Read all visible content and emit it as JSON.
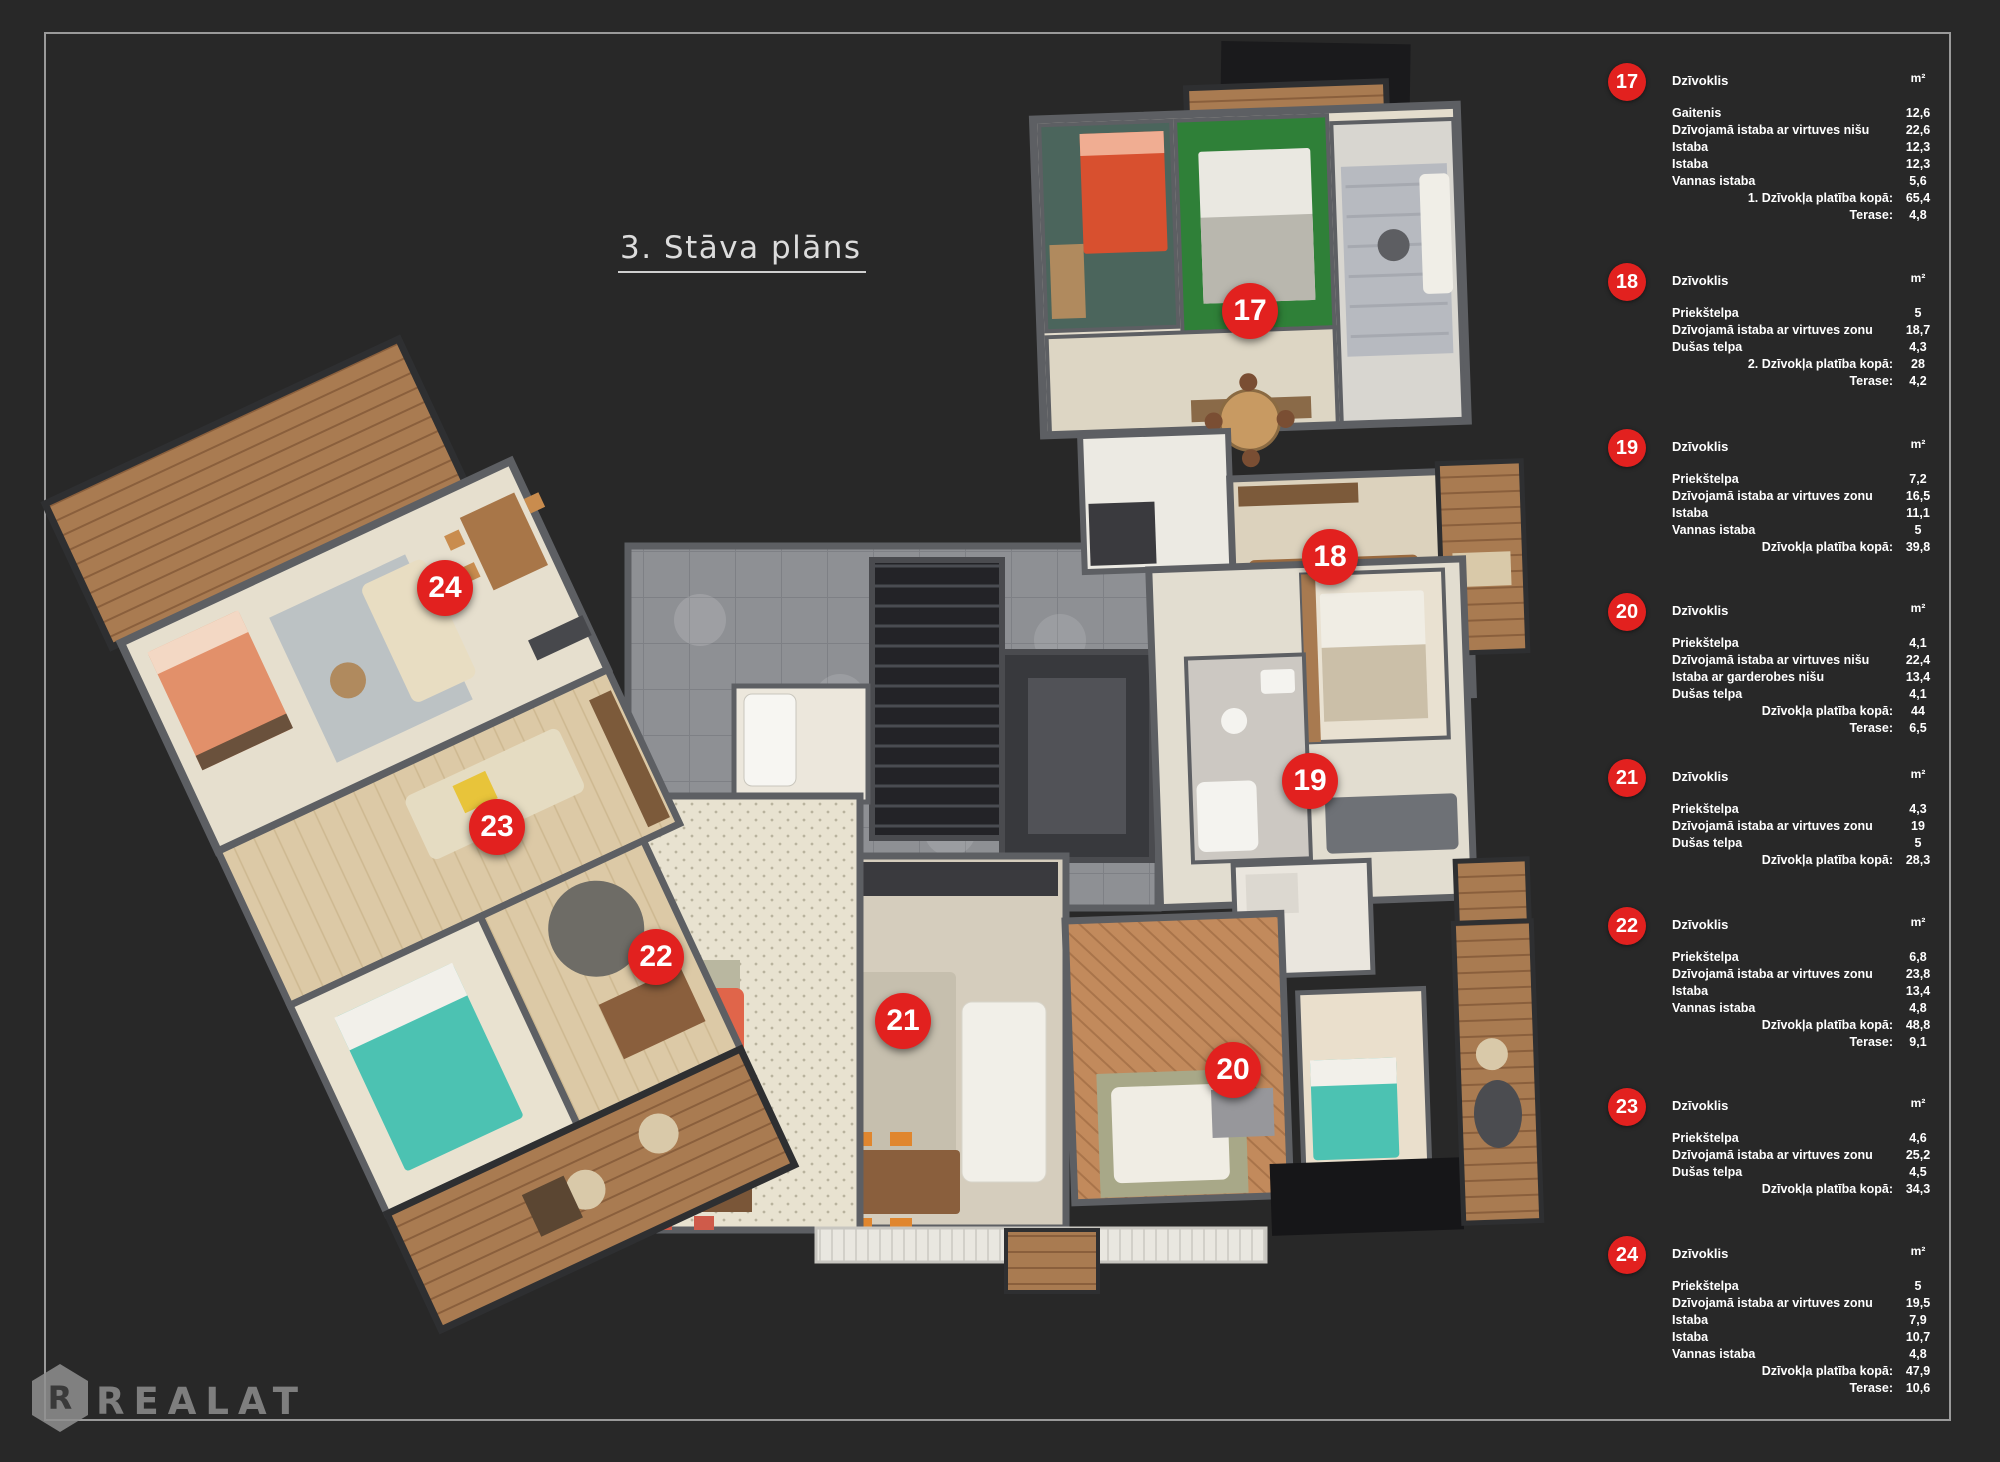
{
  "page": {
    "title": "3. Stāva plāns",
    "background_color": "#282828",
    "accent_red": "#e2211f",
    "logo": {
      "text": "REALAT",
      "monogram": "R"
    }
  },
  "floor_plan": {
    "markers": [
      {
        "number": "17",
        "x": 1250,
        "y": 311
      },
      {
        "number": "18",
        "x": 1330,
        "y": 557
      },
      {
        "number": "19",
        "x": 1310,
        "y": 781
      },
      {
        "number": "20",
        "x": 1233,
        "y": 1070
      },
      {
        "number": "21",
        "x": 903,
        "y": 1021
      },
      {
        "number": "22",
        "x": 656,
        "y": 957
      },
      {
        "number": "23",
        "x": 497,
        "y": 827
      },
      {
        "number": "24",
        "x": 445,
        "y": 588
      }
    ]
  },
  "legend": {
    "header_label": "Dzīvoklis",
    "unit": "m²",
    "apartments": [
      {
        "number": "17",
        "top": 63,
        "rows": [
          [
            "Gaitenis",
            "12,6"
          ],
          [
            "Dzīvojamā istaba ar virtuves nišu",
            "22,6"
          ],
          [
            "Istaba",
            "12,3"
          ],
          [
            "Istaba",
            "12,3"
          ],
          [
            "Vannas istaba",
            "5,6"
          ]
        ],
        "totals": [
          [
            "1. Dzīvokļa platība kopā:",
            "65,4"
          ],
          [
            "Terase:",
            "4,8"
          ]
        ]
      },
      {
        "number": "18",
        "top": 263,
        "rows": [
          [
            "Priekštelpa",
            "5"
          ],
          [
            "Dzīvojamā istaba ar virtuves zonu",
            "18,7"
          ],
          [
            "Dušas telpa",
            "4,3"
          ]
        ],
        "totals": [
          [
            "2. Dzīvokļa platība kopā:",
            "28"
          ],
          [
            "Terase:",
            "4,2"
          ]
        ]
      },
      {
        "number": "19",
        "top": 429,
        "rows": [
          [
            "Priekštelpa",
            "7,2"
          ],
          [
            "Dzīvojamā istaba ar virtuves zonu",
            "16,5"
          ],
          [
            "Istaba",
            "11,1"
          ],
          [
            "Vannas istaba",
            "5"
          ]
        ],
        "totals": [
          [
            "Dzīvokļa platība kopā:",
            "39,8"
          ]
        ]
      },
      {
        "number": "20",
        "top": 593,
        "rows": [
          [
            "Priekštelpa",
            "4,1"
          ],
          [
            "Dzīvojamā istaba ar virtuves nišu",
            "22,4"
          ],
          [
            "Istaba ar garderobes nišu",
            "13,4"
          ],
          [
            "Dušas telpa",
            "4,1"
          ]
        ],
        "totals": [
          [
            "Dzīvokļa platība kopā:",
            "44"
          ],
          [
            "Terase:",
            "6,5"
          ]
        ]
      },
      {
        "number": "21",
        "top": 759,
        "rows": [
          [
            "Priekštelpa",
            "4,3"
          ],
          [
            "Dzīvojamā istaba ar virtuves zonu",
            "19"
          ],
          [
            "Dušas telpa",
            "5"
          ]
        ],
        "totals": [
          [
            "Dzīvokļa platība kopā:",
            "28,3"
          ]
        ]
      },
      {
        "number": "22",
        "top": 907,
        "rows": [
          [
            "Priekštelpa",
            "6,8"
          ],
          [
            "Dzīvojamā istaba ar virtuves zonu",
            "23,8"
          ],
          [
            "Istaba",
            "13,4"
          ],
          [
            "Vannas istaba",
            "4,8"
          ]
        ],
        "totals": [
          [
            "Dzīvokļa platība kopā:",
            "48,8"
          ],
          [
            "Terase:",
            "9,1"
          ]
        ]
      },
      {
        "number": "23",
        "top": 1088,
        "rows": [
          [
            "Priekštelpa",
            "4,6"
          ],
          [
            "Dzīvojamā istaba ar virtuves zonu",
            "25,2"
          ],
          [
            "Dušas telpa",
            "4,5"
          ]
        ],
        "totals": [
          [
            "Dzīvokļa platība kopā:",
            "34,3"
          ]
        ]
      },
      {
        "number": "24",
        "top": 1236,
        "rows": [
          [
            "Priekštelpa",
            "5"
          ],
          [
            "Dzīvojamā istaba ar virtuves zonu",
            "19,5"
          ],
          [
            "Istaba",
            "7,9"
          ],
          [
            "Istaba",
            "10,7"
          ],
          [
            "Vannas istaba",
            "4,8"
          ]
        ],
        "totals": [
          [
            "Dzīvokļa platība kopā:",
            "47,9"
          ],
          [
            "Terase:",
            "10,6"
          ]
        ]
      }
    ]
  }
}
